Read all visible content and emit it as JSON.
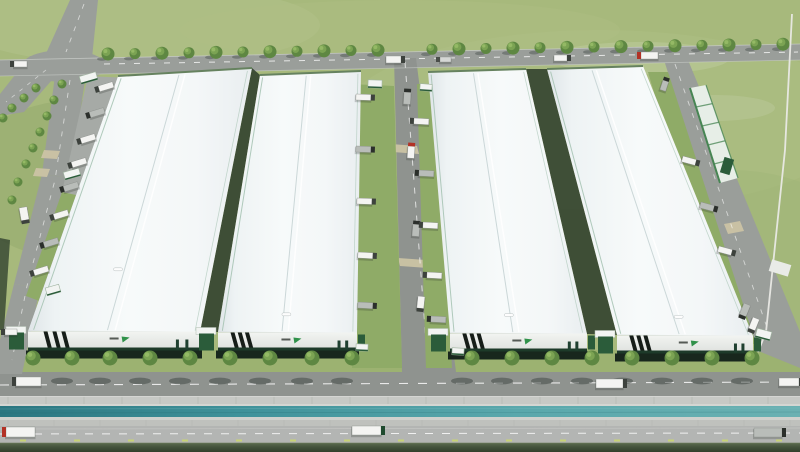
{
  "scene": {
    "description": "Aerial 3D rendering of an industrial logistics park with four white warehouse buildings, perimeter roads, tree-lined frontage road, canal and trucks",
    "colors": {
      "grass": "#a7b97c",
      "grassFront": "#9cb271",
      "road": "#9a9e9a",
      "roadDark": "#8f938f",
      "roadLight": "#b3b5b3",
      "pad": "#a6aaa6",
      "sidewalk": "#c7c9c5",
      "sidewalk2": "#bfc1bd",
      "joint": "#a8aea6",
      "pocket": "#8fab67",
      "alley": "#33432f",
      "tan": "#cbc3a4",
      "fence": "#e9e9e5",
      "ridge": "#c7d4d5",
      "ridgeHi": "#ffffff",
      "gutter": "#a4c2b1",
      "endTrim": "#66825f",
      "facade": "#eceeeb",
      "base": "#1d3a29",
      "stripe": "#161d18",
      "dock": "#18271d",
      "gate": "#2b5c3a",
      "gateRoof": "#f2f4f2",
      "logoGreen": "#2f9149",
      "logoText": "#3b413b",
      "treeDark": "#5e8742",
      "tree": "#7ba353",
      "treeLight": "#97bb67",
      "shadow": "#3c4340",
      "trailerWhite": "#f4f4f2",
      "trailerDark": "#b9bdb9",
      "trailerGray": "#d5d7d5",
      "cabDark": "#3d423d",
      "cabRed": "#b23226",
      "cabGreen": "#1e4a2e",
      "dashYellow": "#c9d56f",
      "greenBld": "#e7eee7",
      "greenBldEdge": "#478553"
    },
    "mottles": [
      [
        140,
        25,
        180,
        40,
        "#b4c48b",
        0.5
      ],
      [
        600,
        120,
        260,
        90,
        "#b0c086",
        0.45
      ],
      [
        80,
        180,
        120,
        80,
        "#93a96c",
        0.5
      ],
      [
        730,
        260,
        140,
        90,
        "#9fb577",
        0.5
      ],
      [
        400,
        30,
        220,
        30,
        "#aebe85",
        0.4
      ],
      [
        640,
        58,
        90,
        16,
        "#ffffff",
        0.12
      ],
      [
        715,
        108,
        60,
        13,
        "#ffffff",
        0.1
      ]
    ],
    "esplanade": [
      {
        "name": "front-grass-strip",
        "y": 350,
        "h": 23,
        "fill": "grassFront"
      },
      {
        "name": "front-road",
        "y": 372,
        "h": 24,
        "fill": "roadDark"
      },
      {
        "name": "sidewalk-upper",
        "y": 396,
        "h": 8,
        "fill": "sidewalk"
      },
      {
        "name": "canal-edge-upper",
        "y": 404,
        "h": 2,
        "fill": "#d4d6d2"
      },
      {
        "name": "canal",
        "y": 406,
        "h": 11,
        "fill": "url(#waterG)"
      },
      {
        "name": "canal-edge-lower",
        "y": 417,
        "h": 3,
        "fill": "#cfd1cd"
      },
      {
        "name": "sidewalk-lower",
        "y": 420,
        "h": 6,
        "fill": "sidewalk2"
      },
      {
        "name": "bottom-road",
        "y": 426,
        "h": 17,
        "fill": "roadLight"
      },
      {
        "name": "boundary-hedge",
        "y": 443,
        "h": 9,
        "fill": "url(#hedgeG)"
      }
    ],
    "roads": [
      {
        "name": "top-road",
        "pts": "0,60 800,44 800,60 0,76",
        "fill": "road"
      },
      {
        "name": "north-road",
        "pts": "70,0 98,0 92,58 44,58",
        "fill": "road"
      },
      {
        "name": "west-road",
        "pts": "30,56 66,64 24,112 0,116 0,94",
        "fill": "road"
      },
      {
        "name": "left-road-upper",
        "pts": "56,68 86,74 70,178 42,174",
        "fill": "road"
      },
      {
        "name": "left-road-mid",
        "pts": "42,174 70,178 40,288 14,284",
        "fill": "road"
      },
      {
        "name": "left-road-lower",
        "pts": "14,284 40,288 22,374 0,374 0,340",
        "fill": "road"
      },
      {
        "name": "central-road",
        "pts": "394,58 416,58 456,372 402,372",
        "fill": "roadDark"
      },
      {
        "name": "right-road",
        "pts": "664,60 688,60 800,332 800,368 756,350",
        "fill": "road"
      },
      {
        "name": "parking-apron",
        "pts": "88,76 128,78 98,200 62,192",
        "fill": "pad"
      }
    ],
    "intersection": {
      "cx": 64,
      "cy": 66,
      "rx": 42,
      "ry": 16
    },
    "pockets": [
      "350,84 394,86 402,368 352,368",
      "417,84 438,84 452,368 426,368",
      "62,192 98,200 42,302 26,296",
      "648,72 668,72 756,344 728,344"
    ],
    "shades": [
      {
        "pts": "252,68 260,75 218,332 200,332",
        "o": 0.9
      },
      {
        "pts": "526,69 547,69 617,335 587,334",
        "o": 0.9
      },
      {
        "pts": "118,76 125,76 35,331 28,331",
        "o": 0.75
      },
      {
        "pts": "0,238 10,240 4,330 0,330",
        "o": 0.8
      }
    ],
    "tanPads": [
      "391,144 417,146 419,154 393,152",
      "398,258 426,260 428,268 400,266",
      "724,224 740,221 744,231 728,234",
      "44,150 60,151 57,159 41,158",
      "36,168 50,169 47,177 33,176"
    ],
    "dashes": [
      {
        "pts": "104,64 798,52",
        "dash": "6 9",
        "w": 1,
        "c": "#ffffff",
        "o": 0.75
      },
      {
        "pts": "84,4 66,52",
        "dash": "5 7",
        "w": 0.9,
        "c": "#ffffff",
        "o": 0.6
      },
      {
        "pts": "46,70 6,102",
        "dash": "4 6",
        "w": 0.8,
        "c": "#ffffff",
        "o": 0.55
      },
      {
        "pts": "70,80 55,180 27,286 12,360",
        "dash": "5 8",
        "w": 0.9,
        "c": "#ffffff",
        "o": 0.6
      },
      {
        "pts": "405,62 428,368",
        "dash": "6 8",
        "w": 1,
        "c": "#ffffff",
        "o": 0.7
      },
      {
        "pts": "675,64 770,336",
        "dash": "5 8",
        "w": 0.9,
        "c": "#ffffff",
        "o": 0.6
      },
      {
        "pts": "0,385 800,382",
        "dash": "9 10",
        "w": 1.1,
        "c": "#ffffff",
        "o": 0.8
      },
      {
        "pts": "0,434 800,433",
        "dash": "8 9",
        "w": 1,
        "c": "#ffffff",
        "o": 0.8
      },
      {
        "pts": "0,429 800,428",
        "dash": "",
        "w": 0.7,
        "c": "#d8d8d6",
        "o": 0.5
      },
      {
        "pts": "0,60 800,44",
        "dash": "",
        "w": 0.8,
        "c": "#c6cac6",
        "o": 0.9
      },
      {
        "pts": "0,76 800,60",
        "dash": "",
        "w": 0.8,
        "c": "#c6cac6",
        "o": 0.7
      },
      {
        "pts": "0,396.5 800,396.5",
        "dash": "",
        "w": 1,
        "c": "#d8dad6",
        "o": 0.8
      },
      {
        "pts": "0,409 800,408",
        "dash": "",
        "w": 0.6,
        "c": "#8ec9cb",
        "o": 0.35
      },
      {
        "pts": "0,413 800,412",
        "dash": "",
        "w": 0.6,
        "c": "#1e5f68",
        "o": 0.3
      },
      {
        "pts": "0,443 800,443",
        "dash": "",
        "w": 0.8,
        "c": "#6d7c5c",
        "o": 0.8
      }
    ],
    "fence": "792,14 785,150 766,332 758,352",
    "greenBuilding": {
      "quad": "690,88 706,85 738,178 720,183",
      "cross": 4,
      "box": [
        722,
        158,
        10,
        16,
        17
      ],
      "shed": [
        770,
        262,
        20,
        12,
        17
      ]
    },
    "buildings": [
      {
        "name": "warehouse-1",
        "quad": [
          [
            118,
            76
          ],
          [
            252,
            68
          ],
          [
            200,
            332
          ],
          [
            28,
            331
          ]
        ],
        "facadeH": 19,
        "dockH": 8,
        "vent": [
          0.42,
          0.76
        ]
      },
      {
        "name": "warehouse-2",
        "quad": [
          [
            260,
            75
          ],
          [
            361,
            71
          ],
          [
            357,
            333
          ],
          [
            218,
            332
          ]
        ],
        "facadeH": 18,
        "dockH": 8,
        "vent": [
          0.48,
          0.93
        ]
      },
      {
        "name": "warehouse-3",
        "quad": [
          [
            428,
            72
          ],
          [
            526,
            69
          ],
          [
            587,
            334
          ],
          [
            450,
            333
          ]
        ],
        "facadeH": 18,
        "dockH": 8,
        "vent": [
          0.45,
          0.93
        ]
      },
      {
        "name": "warehouse-4",
        "quad": [
          [
            547,
            69
          ],
          [
            643,
            66
          ],
          [
            753,
            336
          ],
          [
            617,
            335
          ]
        ],
        "facadeH": 18,
        "dockH": 8,
        "vent": [
          0.5,
          0.93
        ]
      }
    ],
    "canopies": [
      [
        80,
        74,
        17,
        8,
        -16
      ],
      [
        64,
        170,
        16,
        8,
        -16
      ],
      [
        46,
        286,
        14,
        8,
        -16
      ],
      [
        368,
        80,
        14,
        8,
        2
      ],
      [
        420,
        84,
        12,
        7,
        4
      ],
      [
        356,
        344,
        12,
        7,
        2
      ],
      [
        452,
        348,
        12,
        7,
        3
      ],
      [
        756,
        330,
        15,
        9,
        15
      ]
    ],
    "trees": {
      "topRow": [
        [
          108,
          54
        ],
        [
          135,
          53.6
        ],
        [
          162,
          53.2
        ],
        [
          189,
          52.8
        ],
        [
          216,
          52.4
        ],
        [
          243,
          52
        ],
        [
          270,
          51.7
        ],
        [
          297,
          51.3
        ],
        [
          324,
          50.9
        ],
        [
          351,
          50.5
        ],
        [
          378,
          50.1
        ],
        [
          432,
          49.3
        ],
        [
          459,
          48.9
        ],
        [
          486,
          48.5
        ],
        [
          513,
          48.1
        ],
        [
          540,
          47.7
        ],
        [
          567,
          47.4
        ],
        [
          594,
          47
        ],
        [
          621,
          46.6
        ],
        [
          648,
          46.2
        ],
        [
          675,
          45.8
        ],
        [
          702,
          45.4
        ],
        [
          729,
          45
        ],
        [
          756,
          44.6
        ],
        [
          783,
          44.2
        ]
      ],
      "frontRowXs": [
        33,
        72,
        110,
        150,
        190,
        230,
        270,
        312,
        352,
        472,
        512,
        552,
        592,
        632,
        672,
        712,
        752
      ],
      "frontRowY": 358,
      "leftRows": [
        [
          62,
          84
        ],
        [
          54,
          100
        ],
        [
          47,
          116
        ],
        [
          40,
          132
        ],
        [
          33,
          148
        ],
        [
          26,
          164
        ],
        [
          18,
          182
        ],
        [
          12,
          200
        ],
        [
          36,
          88
        ],
        [
          24,
          98
        ],
        [
          12,
          108
        ],
        [
          3,
          118
        ]
      ]
    },
    "trucks": [
      [
        14,
        61,
        13,
        6,
        0,
        "l",
        "white"
      ],
      [
        386,
        56,
        15,
        7,
        0,
        "r",
        "white"
      ],
      [
        440,
        57,
        11,
        5,
        0,
        "l",
        "gray"
      ],
      [
        554,
        55,
        13,
        6,
        0,
        "r",
        "white"
      ],
      [
        641,
        52,
        17,
        7,
        0,
        "l",
        "red"
      ],
      [
        404,
        92,
        7,
        12,
        3,
        "t",
        "dark"
      ],
      [
        408,
        146,
        7,
        12,
        4,
        "t",
        "red"
      ],
      [
        413,
        224,
        7,
        12,
        5,
        "t",
        "dark"
      ],
      [
        418,
        296,
        7,
        12,
        6,
        "b",
        "white"
      ],
      [
        16,
        377,
        25,
        9,
        0,
        "l",
        "white"
      ],
      [
        596,
        379,
        27,
        9,
        0,
        "r",
        "white"
      ],
      [
        779,
        378,
        20,
        8,
        0,
        "r",
        "white"
      ],
      [
        6,
        427,
        29,
        10,
        0,
        "l",
        "red"
      ],
      [
        352,
        426,
        29,
        9,
        0,
        "r",
        "greencab"
      ],
      [
        754,
        428,
        28,
        9,
        0,
        "r",
        "dark"
      ],
      [
        19,
        208,
        8,
        13,
        -10,
        "b",
        "white"
      ],
      [
        5,
        329,
        12,
        6,
        0,
        "l",
        "white"
      ],
      [
        663,
        80,
        6,
        10,
        18,
        "t",
        "dark"
      ],
      [
        744,
        303,
        7,
        12,
        22,
        "b",
        "dark"
      ],
      [
        753,
        317,
        7,
        12,
        22,
        "b",
        "white"
      ],
      [
        98,
        86,
        15,
        6,
        -17,
        "l",
        "white"
      ],
      [
        89,
        112,
        15,
        6,
        -17,
        "l",
        "dark"
      ],
      [
        80,
        138,
        15,
        6,
        -17,
        "l",
        "white"
      ],
      [
        71,
        162,
        15,
        6,
        -17,
        "l",
        "white"
      ],
      [
        63,
        186,
        15,
        6,
        -17,
        "l",
        "dark"
      ],
      [
        53,
        214,
        15,
        6,
        -17,
        "l",
        "white"
      ],
      [
        43,
        242,
        15,
        6,
        -17,
        "l",
        "dark"
      ],
      [
        33,
        270,
        15,
        6,
        -17,
        "l",
        "white"
      ],
      [
        356,
        94,
        15,
        6,
        2,
        "r",
        "white"
      ],
      [
        356,
        146,
        15,
        6,
        2,
        "r",
        "dark"
      ],
      [
        357,
        198,
        15,
        6,
        2,
        "r",
        "white"
      ],
      [
        358,
        252,
        15,
        6,
        3,
        "r",
        "white"
      ],
      [
        358,
        302,
        15,
        6,
        3,
        "r",
        "dark"
      ],
      [
        414,
        118,
        15,
        6,
        3,
        "l",
        "white"
      ],
      [
        419,
        170,
        15,
        6,
        3,
        "l",
        "dark"
      ],
      [
        423,
        222,
        15,
        6,
        3,
        "l",
        "white"
      ],
      [
        427,
        272,
        15,
        6,
        3,
        "l",
        "white"
      ],
      [
        431,
        316,
        15,
        6,
        3,
        "l",
        "dark"
      ],
      [
        683,
        156,
        14,
        6,
        15,
        "r",
        "white"
      ],
      [
        701,
        202,
        14,
        6,
        15,
        "r",
        "dark"
      ],
      [
        719,
        246,
        14,
        6,
        15,
        "r",
        "white"
      ]
    ],
    "joints": [
      {
        "y": 396,
        "h": 8,
        "step": 38,
        "o": 0.6
      },
      {
        "y": 420,
        "h": 6,
        "step": 46,
        "o": 0.4
      }
    ],
    "yellowDashes": {
      "y": 439.5,
      "w": 6,
      "h": 2,
      "step": 54,
      "x0": 20
    }
  }
}
